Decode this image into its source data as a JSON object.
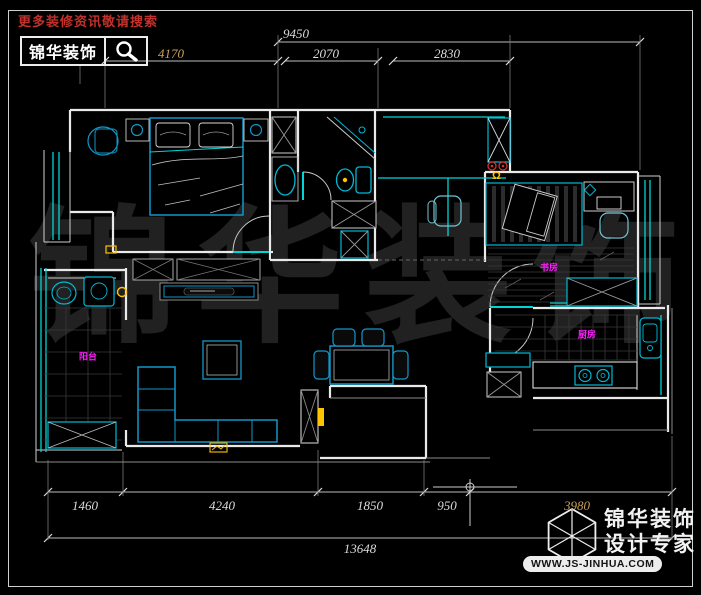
{
  "header": {
    "promo": "更多装修资讯敬请搜索",
    "brand": "锦华装饰"
  },
  "dimensions": {
    "top": {
      "total": "9450",
      "segments": [
        "4170",
        "2070",
        "2830"
      ]
    },
    "bottom": {
      "segments": [
        "1460",
        "4240",
        "1850",
        "950",
        "3980"
      ],
      "total": "13648"
    }
  },
  "rooms": [
    {
      "label": "阳台"
    },
    {
      "label": "书房"
    },
    {
      "label": "厨房"
    }
  ],
  "watermark": {
    "chars": [
      "锦",
      "华",
      "装",
      "饰"
    ]
  },
  "symbols": {
    "omega": "Ω"
  },
  "footer_logo": {
    "brand": "锦华装饰",
    "tagline": "设计专家",
    "website": "WWW.JS-JINHUA.COM"
  },
  "colors": {
    "background": "#000000",
    "wall": "#e9e9e9",
    "window_cyan": "#00d6d6",
    "furniture_blue": "#1496c8",
    "label_magenta": "#ff1cff",
    "symbol_yellow": "#ffc400",
    "symbol_red": "#d23232",
    "promo_red": "#c2312b",
    "dim_text": "#dcdcdc",
    "dim_text_gold": "#c9a05a",
    "watermark_gray": "#212121"
  }
}
